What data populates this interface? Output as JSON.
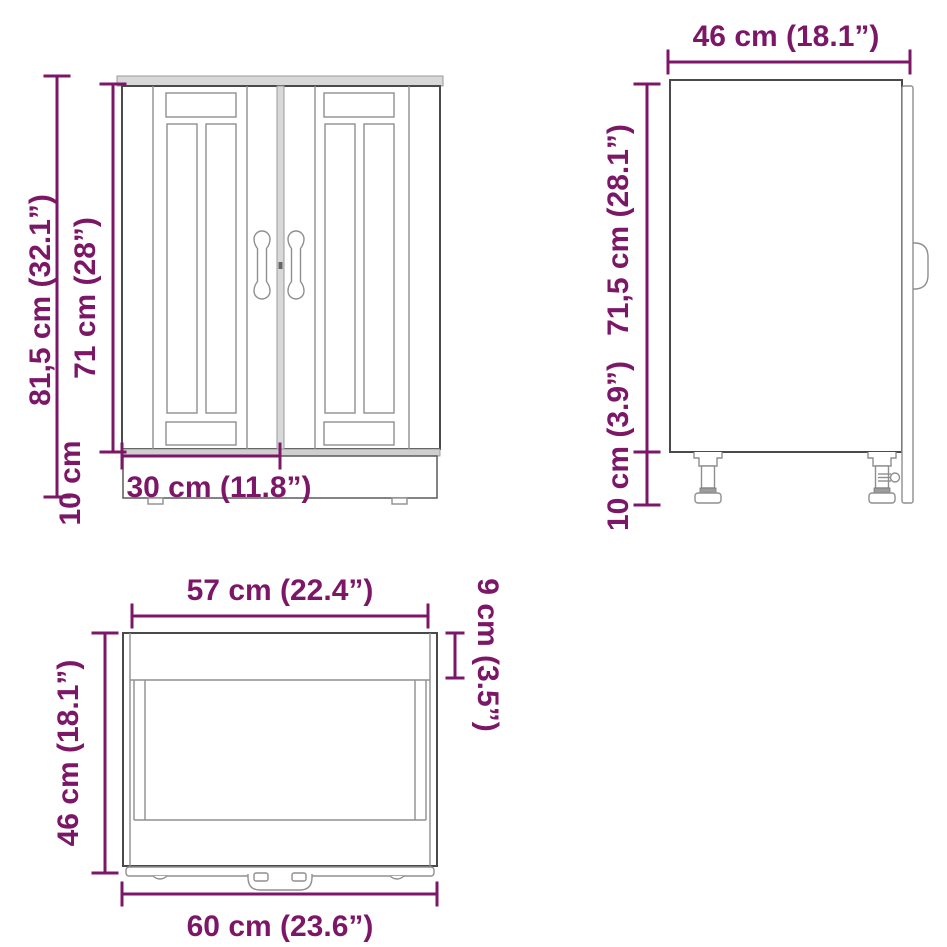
{
  "colors": {
    "dimension_accent": "#7c1768",
    "outline": "#4a4a4a",
    "detail_line": "#8f8f8f",
    "background": "#ffffff"
  },
  "views": {
    "front": {
      "dims": {
        "total_height": "81,5 cm (32.1”)",
        "door_height": "71 cm (28”)",
        "plinth_height": "10 cm",
        "door_width": "30 cm (11.8”)"
      }
    },
    "side": {
      "dims": {
        "depth": "46 cm (18.1”)",
        "body_height": "71,5 cm (28.1”)",
        "leg_height": "10 cm (3.9”)"
      }
    },
    "top": {
      "dims": {
        "carcass_width": "57 cm (22.4”)",
        "front_depth": "9 cm (3.5”)",
        "depth": "46 cm (18.1”)",
        "total_width": "60 cm (23.6”)"
      }
    }
  }
}
